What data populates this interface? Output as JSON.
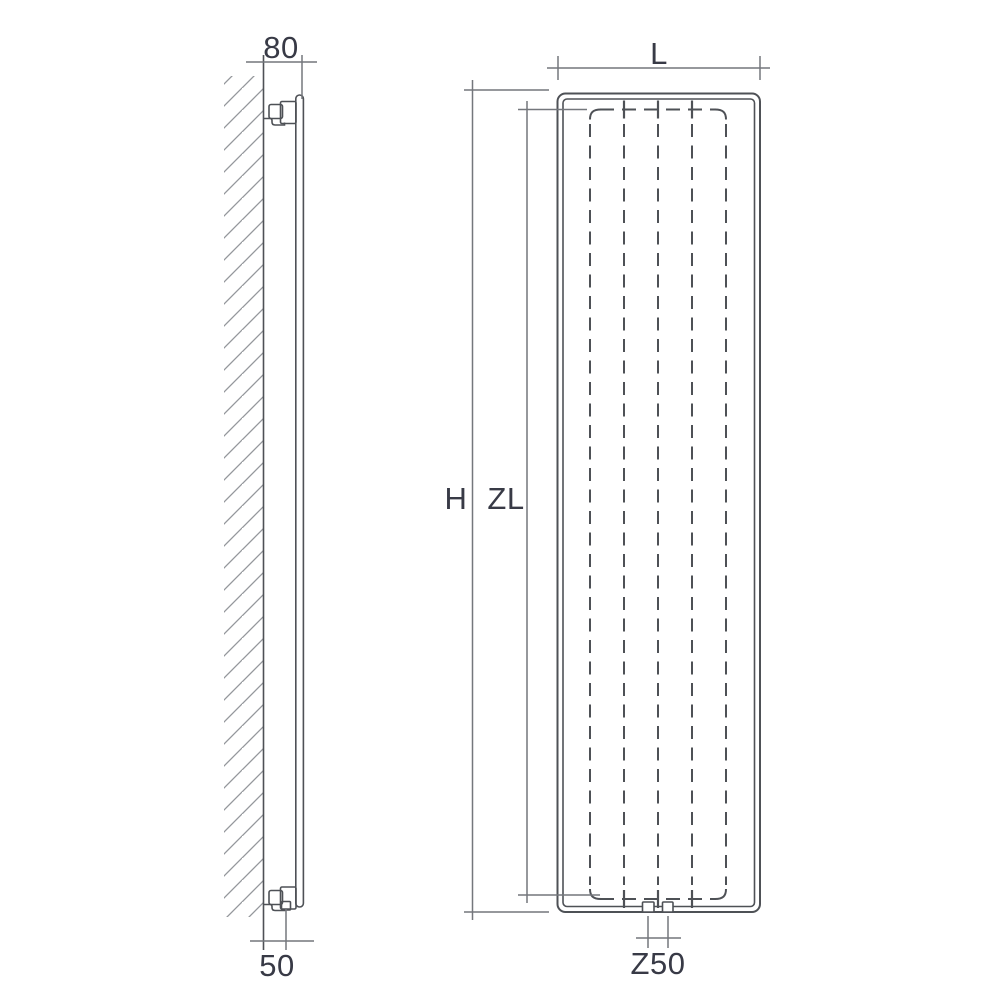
{
  "labels": {
    "wall_clearance_top": "80",
    "wall_clearance_bottom": "50",
    "width": "L",
    "height": "H",
    "inner_height": "ZL",
    "connection_spacing": "Z50"
  },
  "colors": {
    "background": "#ffffff",
    "line": "#4e5156",
    "dim_line": "#74777c",
    "hatch": "#94979c",
    "label_text": "#383a46"
  }
}
